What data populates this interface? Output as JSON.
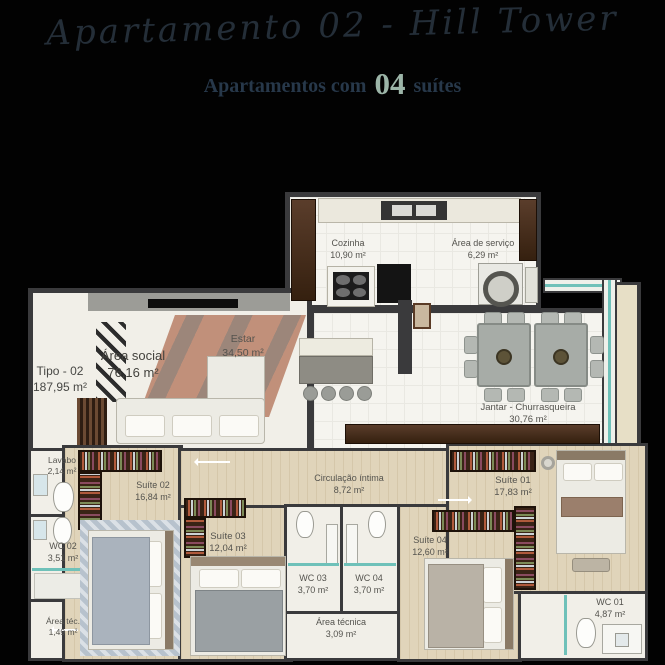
{
  "header": {
    "script_title": "Apartamento 02 - Hill Tower",
    "subtitle_prefix": "Apartamentos com",
    "subtitle_number": "04",
    "subtitle_suffix": "suítes"
  },
  "unit": {
    "type_label": "Tipo - 02",
    "total_area": "187,95 m²"
  },
  "rooms": {
    "cozinha": {
      "name": "Cozinha",
      "area": "10,90 m²"
    },
    "area_servico": {
      "name": "Área de serviço",
      "area": "6,29 m²"
    },
    "area_social": {
      "name": "Área social",
      "area": "76,16 m²"
    },
    "estar": {
      "name": "Estar",
      "area": "34,50 m²"
    },
    "jantar": {
      "name": "Jantar - Churrasqueira",
      "area": "30,76 m²"
    },
    "lavabo": {
      "name": "Lavabo",
      "area": "2,14 m²"
    },
    "suite01": {
      "name": "Suíte 01",
      "area": "17,83 m²"
    },
    "suite02": {
      "name": "Suíte 02",
      "area": "16,84 m²"
    },
    "suite03": {
      "name": "Suíte 03",
      "area": "12,04 m²"
    },
    "suite04": {
      "name": "Suíte 04",
      "area": "12,60 m²"
    },
    "wc01": {
      "name": "WC 01",
      "area": "4,87 m²"
    },
    "wc02": {
      "name": "WC 02",
      "area": "3,51 m²"
    },
    "wc03": {
      "name": "WC 03",
      "area": "3,70 m²"
    },
    "wc04": {
      "name": "WC 04",
      "area": "3,70 m²"
    },
    "circulacao": {
      "name": "Circulação íntima",
      "area": "8,72 m²"
    },
    "area_tecnica": {
      "name": "Área técnica",
      "area": "3,09 m²"
    },
    "area_tec": {
      "name": "Área téc.",
      "area": "1,49 m²"
    }
  },
  "colors": {
    "accent_number": "#9cb5a8",
    "glass_teal": "#6fc1b9",
    "wall_dark": "#3a3a3c",
    "wood_floor": "#e0d4ba",
    "dark_wood": "#4b3122"
  }
}
